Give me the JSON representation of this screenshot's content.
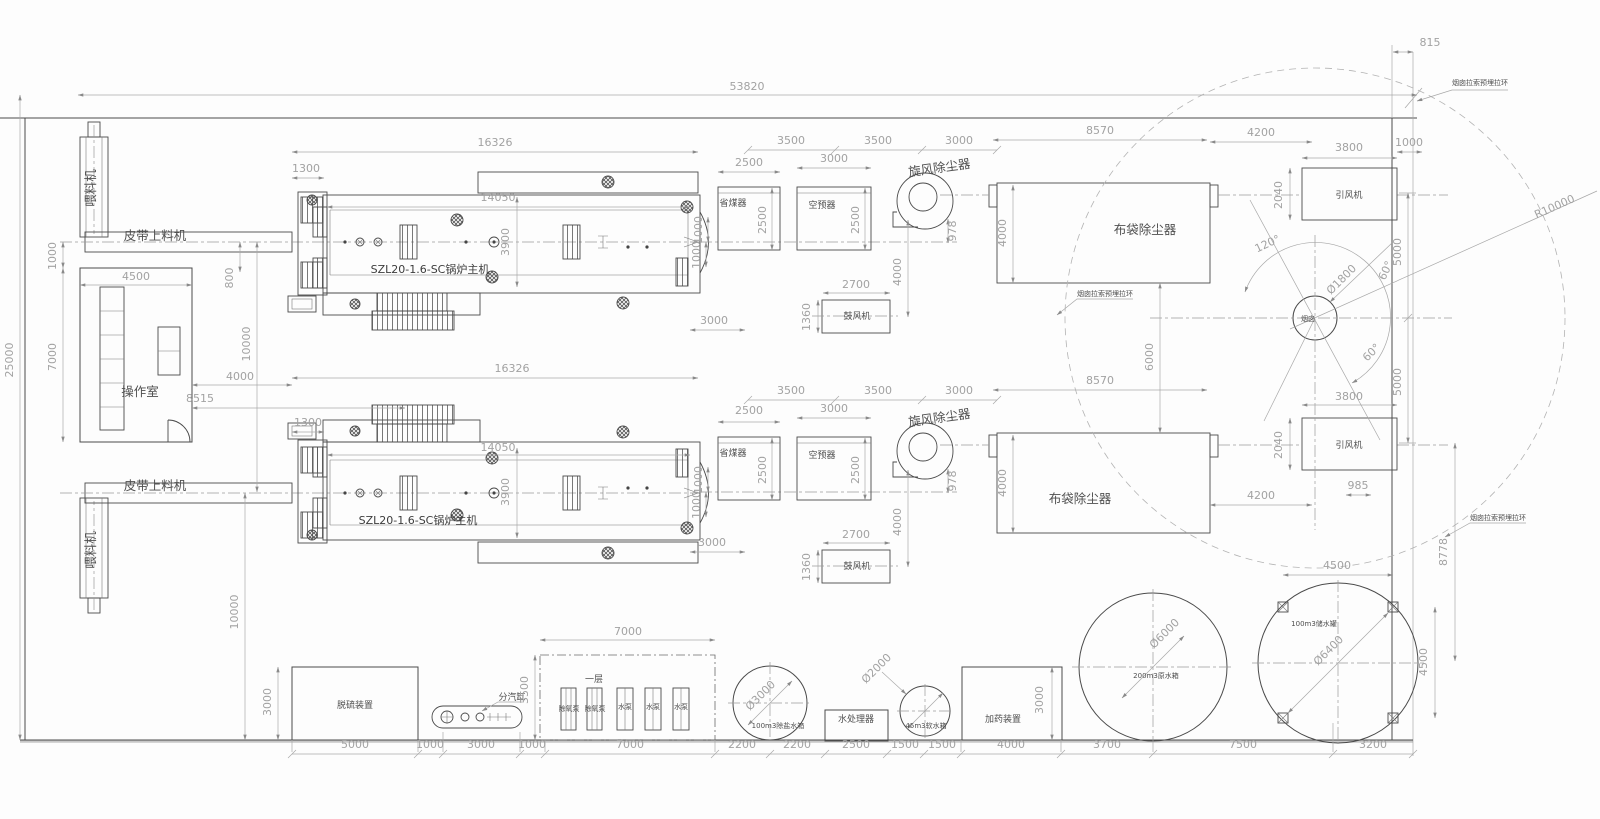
{
  "drawing": {
    "type": "boiler-plant-layout-plan",
    "boiler_model": "SZL20-1.6-SC锅炉主机",
    "site_width_label": "53820",
    "site_height_label": "25000"
  },
  "colors": {
    "line": "#4a4a4a",
    "dim_text": "#a2a2a2",
    "label_text": "#4f4f4f",
    "background": "#fdfdfd"
  },
  "texts": [
    {
      "n": "dim-site-width",
      "t": "53820",
      "x": 747,
      "y": 90
    },
    {
      "n": "dim-815",
      "t": "815",
      "x": 1430,
      "y": 46
    },
    {
      "n": "label-guy-ring-1",
      "t": "烟囱拉索预埋拉环",
      "x": 1480,
      "y": 85,
      "c": "tiny"
    },
    {
      "n": "dim-r10000",
      "t": "R10000",
      "x": 1556,
      "y": 210,
      "r": -24
    },
    {
      "n": "dim-1000-idfan1",
      "t": "1000",
      "x": 1409,
      "y": 146
    },
    {
      "n": "dim-3800-idfan1",
      "t": "3800",
      "x": 1349,
      "y": 151
    },
    {
      "n": "dim-4200-1",
      "t": "4200",
      "x": 1261,
      "y": 136
    },
    {
      "n": "dim-8570-1",
      "t": "8570",
      "x": 1100,
      "y": 134
    },
    {
      "n": "dim-3000-chain1",
      "t": "3000",
      "x": 959,
      "y": 144
    },
    {
      "n": "dim-3500-chain1b",
      "t": "3500",
      "x": 878,
      "y": 144
    },
    {
      "n": "dim-3500-chain1a",
      "t": "3500",
      "x": 791,
      "y": 144
    },
    {
      "n": "dim-2500-econ1",
      "t": "2500",
      "x": 749,
      "y": 166
    },
    {
      "n": "dim-3000-aph1",
      "t": "3000",
      "x": 834,
      "y": 162
    },
    {
      "n": "dim-16326-1",
      "t": "16326",
      "x": 495,
      "y": 146
    },
    {
      "n": "dim-1300-1",
      "t": "1300",
      "x": 306,
      "y": 172
    },
    {
      "n": "dim-14050-1",
      "t": "14050",
      "x": 498,
      "y": 201
    },
    {
      "n": "label-cyclone-1",
      "t": "旋风除尘器",
      "x": 940,
      "y": 172,
      "r": -8,
      "c": "lbl"
    },
    {
      "n": "label-economizer-1",
      "t": "省煤器",
      "x": 733,
      "y": 206,
      "c": "sm"
    },
    {
      "n": "label-air-preheater-1",
      "t": "空预器",
      "x": 822,
      "y": 208,
      "c": "sm"
    },
    {
      "n": "dim-2500v-econ1",
      "t": "2500",
      "x": 766,
      "y": 220,
      "r": -90
    },
    {
      "n": "dim-2500v-aph1",
      "t": "2500",
      "x": 859,
      "y": 220,
      "r": -90
    },
    {
      "n": "dim-1000v-econ1",
      "t": "1000",
      "x": 702,
      "y": 230,
      "r": -90
    },
    {
      "n": "dim-3900-1",
      "t": "3900",
      "x": 509,
      "y": 242,
      "r": -90
    },
    {
      "n": "dim-1000v-boiler1",
      "t": "1000",
      "x": 700,
      "y": 255,
      "r": -90
    },
    {
      "n": "label-boiler-1",
      "t": "SZL20-1.6-SC锅炉主机",
      "x": 430,
      "y": 273,
      "c": "lbl2"
    },
    {
      "n": "label-hopper-feeder-1",
      "t": "喂料机",
      "x": 95,
      "y": 188,
      "r": -90,
      "c": "lbl"
    },
    {
      "n": "label-belt-feeder-1",
      "t": "皮带上料机",
      "x": 155,
      "y": 240,
      "c": "lbl"
    },
    {
      "n": "dim-1000-room",
      "t": "1000",
      "x": 56,
      "y": 256,
      "r": -90
    },
    {
      "n": "dim-4500-room",
      "t": "4500",
      "x": 136,
      "y": 280
    },
    {
      "n": "dim-7000-room",
      "t": "7000",
      "x": 56,
      "y": 357,
      "r": -90
    },
    {
      "n": "label-control-room",
      "t": "操作室",
      "x": 140,
      "y": 396,
      "c": "lbl"
    },
    {
      "n": "dim-8515",
      "t": "8515",
      "x": 200,
      "y": 402
    },
    {
      "n": "dim-4000-room",
      "t": "4000",
      "x": 240,
      "y": 380
    },
    {
      "n": "dim-800",
      "t": "800",
      "x": 233,
      "y": 278,
      "r": -90
    },
    {
      "n": "dim-10000-upper",
      "t": "10000",
      "x": 250,
      "y": 344,
      "r": -90
    },
    {
      "n": "dim-25000",
      "t": "25000",
      "x": 13,
      "y": 360,
      "r": -90
    },
    {
      "n": "dim-978-1",
      "t": "978",
      "x": 956,
      "y": 231,
      "r": -90
    },
    {
      "n": "dim-4000-cyc1",
      "t": "4000",
      "x": 901,
      "y": 272,
      "r": -90
    },
    {
      "n": "dim-2700-1",
      "t": "2700",
      "x": 856,
      "y": 288
    },
    {
      "n": "dim-1360-1",
      "t": "1360",
      "x": 810,
      "y": 317,
      "r": -90
    },
    {
      "n": "label-blower-1",
      "t": "鼓风机",
      "x": 857,
      "y": 319,
      "c": "sm"
    },
    {
      "n": "dim-3000-gap1",
      "t": "3000",
      "x": 714,
      "y": 324
    },
    {
      "n": "label-baghouse-1",
      "t": "布袋除尘器",
      "x": 1145,
      "y": 234,
      "c": "lbl"
    },
    {
      "n": "dim-4000-bag1",
      "t": "4000",
      "x": 1006,
      "y": 233,
      "r": -90
    },
    {
      "n": "label-guy-ring-2",
      "t": "烟囱拉索预埋拉环",
      "x": 1105,
      "y": 296,
      "c": "tiny"
    },
    {
      "n": "dim-6000",
      "t": "6000",
      "x": 1153,
      "y": 357,
      "r": -90
    },
    {
      "n": "label-id-fan-1",
      "t": "引风机",
      "x": 1349,
      "y": 198,
      "c": "sm"
    },
    {
      "n": "dim-2040-1",
      "t": "2040",
      "x": 1282,
      "y": 195,
      "r": -90
    },
    {
      "n": "dim-120deg",
      "t": "120°",
      "x": 1269,
      "y": 247,
      "r": -25
    },
    {
      "n": "dim-d1800",
      "t": "Ø1800",
      "x": 1344,
      "y": 282,
      "r": -45
    },
    {
      "n": "dim-60deg-a",
      "t": "60°",
      "x": 1389,
      "y": 272,
      "r": -65
    },
    {
      "n": "dim-60deg-b",
      "t": "60°",
      "x": 1374,
      "y": 355,
      "r": -45
    },
    {
      "n": "dim-5000-a",
      "t": "5000",
      "x": 1401,
      "y": 252,
      "r": -90
    },
    {
      "n": "dim-5000-b",
      "t": "5000",
      "x": 1401,
      "y": 382,
      "r": -90
    },
    {
      "n": "label-chimney",
      "t": "烟囱",
      "x": 1308,
      "y": 321,
      "c": "tiny"
    },
    {
      "n": "dim-16326-2",
      "t": "16326",
      "x": 512,
      "y": 372
    },
    {
      "n": "dim-3500-chain2a",
      "t": "3500",
      "x": 791,
      "y": 394
    },
    {
      "n": "dim-3500-chain2b",
      "t": "3500",
      "x": 878,
      "y": 394
    },
    {
      "n": "dim-3000-chain2",
      "t": "3000",
      "x": 959,
      "y": 394
    },
    {
      "n": "dim-8570-2",
      "t": "8570",
      "x": 1100,
      "y": 384
    },
    {
      "n": "dim-2500-econ2",
      "t": "2500",
      "x": 749,
      "y": 414
    },
    {
      "n": "dim-3000-aph2",
      "t": "3000",
      "x": 834,
      "y": 412
    },
    {
      "n": "dim-1300-2",
      "t": "1300",
      "x": 308,
      "y": 426
    },
    {
      "n": "dim-14050-2",
      "t": "14050",
      "x": 498,
      "y": 451
    },
    {
      "n": "label-cyclone-2",
      "t": "旋风除尘器",
      "x": 940,
      "y": 422,
      "r": -8,
      "c": "lbl"
    },
    {
      "n": "label-economizer-2",
      "t": "省煤器",
      "x": 733,
      "y": 456,
      "c": "sm"
    },
    {
      "n": "label-air-preheater-2",
      "t": "空预器",
      "x": 822,
      "y": 458,
      "c": "sm"
    },
    {
      "n": "dim-2500v-econ2",
      "t": "2500",
      "x": 766,
      "y": 470,
      "r": -90
    },
    {
      "n": "dim-2500v-aph2",
      "t": "2500",
      "x": 859,
      "y": 470,
      "r": -90
    },
    {
      "n": "dim-1000v-econ2",
      "t": "1000",
      "x": 702,
      "y": 480,
      "r": -90
    },
    {
      "n": "dim-3900-2",
      "t": "3900",
      "x": 509,
      "y": 492,
      "r": -90
    },
    {
      "n": "dim-3800-idfan2",
      "t": "3800",
      "x": 1349,
      "y": 400
    },
    {
      "n": "label-id-fan-2",
      "t": "引风机",
      "x": 1349,
      "y": 448,
      "c": "sm"
    },
    {
      "n": "dim-2040-2",
      "t": "2040",
      "x": 1282,
      "y": 445,
      "r": -90
    },
    {
      "n": "label-baghouse-2",
      "t": "布袋除尘器",
      "x": 1080,
      "y": 503,
      "c": "lbl"
    },
    {
      "n": "dim-4000-bag2",
      "t": "4000",
      "x": 1006,
      "y": 483,
      "r": -90
    },
    {
      "n": "dim-978-2",
      "t": "978",
      "x": 956,
      "y": 481,
      "r": -90
    },
    {
      "n": "dim-4000-cyc2",
      "t": "4000",
      "x": 901,
      "y": 522,
      "r": -90
    },
    {
      "n": "label-belt-feeder-2",
      "t": "皮带上料机",
      "x": 155,
      "y": 490,
      "c": "lbl"
    },
    {
      "n": "label-hopper-feeder-2",
      "t": "喂料机",
      "x": 95,
      "y": 550,
      "r": -90,
      "c": "lbl"
    },
    {
      "n": "label-boiler-2",
      "t": "SZL20-1.6-SC锅炉主机",
      "x": 418,
      "y": 524,
      "c": "lbl2"
    },
    {
      "n": "dim-1000v-boiler2",
      "t": "1000",
      "x": 700,
      "y": 505,
      "r": -90
    },
    {
      "n": "dim-3000-gap2",
      "t": "3000",
      "x": 712,
      "y": 546
    },
    {
      "n": "dim-2700-2",
      "t": "2700",
      "x": 856,
      "y": 538
    },
    {
      "n": "dim-1360-2",
      "t": "1360",
      "x": 810,
      "y": 567,
      "r": -90
    },
    {
      "n": "label-blower-2",
      "t": "鼓风机",
      "x": 857,
      "y": 569,
      "c": "sm"
    },
    {
      "n": "dim-4200-2",
      "t": "4200",
      "x": 1261,
      "y": 499
    },
    {
      "n": "dim-985",
      "t": "985",
      "x": 1358,
      "y": 489
    },
    {
      "n": "dim-10000-lower",
      "t": "10000",
      "x": 238,
      "y": 612,
      "r": -90
    },
    {
      "n": "dim-8778",
      "t": "8778",
      "x": 1447,
      "y": 552,
      "r": -90
    },
    {
      "n": "dim-4500-tank-v",
      "t": "4500",
      "x": 1427,
      "y": 662,
      "r": -90
    },
    {
      "n": "label-guy-ring-3",
      "t": "烟囱拉索预埋拉环",
      "x": 1498,
      "y": 520,
      "c": "tiny"
    },
    {
      "n": "dim-4500-tank-h",
      "t": "4500",
      "x": 1337,
      "y": 569
    },
    {
      "n": "label-desulfurizer",
      "t": "脱硫装置",
      "x": 355,
      "y": 708,
      "c": "sm"
    },
    {
      "n": "dim-3000-desulf",
      "t": "3000",
      "x": 271,
      "y": 702,
      "r": -90
    },
    {
      "n": "label-steam-header",
      "t": "分汽缸",
      "x": 512,
      "y": 700,
      "c": "sm"
    },
    {
      "n": "dim-3500-pumphouse",
      "t": "3500",
      "x": 528,
      "y": 690,
      "r": -90
    },
    {
      "n": "dim-7000-pumphouse",
      "t": "7000",
      "x": 628,
      "y": 635
    },
    {
      "n": "label-first-floor",
      "t": "一层",
      "x": 594,
      "y": 682,
      "c": "sm"
    },
    {
      "n": "label-deaerator-pump-1",
      "t": "除氧泵",
      "x": 569,
      "y": 711,
      "c": "tiny"
    },
    {
      "n": "label-deaerator-pump-2",
      "t": "除氧泵",
      "x": 595,
      "y": 711,
      "c": "tiny"
    },
    {
      "n": "label-water-pump-1",
      "t": "水泵",
      "x": 625,
      "y": 709,
      "c": "tiny"
    },
    {
      "n": "label-water-pump-2",
      "t": "水泵",
      "x": 653,
      "y": 709,
      "c": "tiny"
    },
    {
      "n": "label-water-pump-3",
      "t": "水泵",
      "x": 681,
      "y": 709,
      "c": "tiny"
    },
    {
      "n": "dim-d3000",
      "t": "Ø3000",
      "x": 763,
      "y": 698,
      "r": -45
    },
    {
      "n": "label-demi-water-tank",
      "t": "100m3除盐水箱",
      "x": 778,
      "y": 728,
      "c": "tiny"
    },
    {
      "n": "label-water-treater",
      "t": "水处理器",
      "x": 856,
      "y": 722,
      "c": "sm"
    },
    {
      "n": "dim-d2000",
      "t": "Ø2000",
      "x": 879,
      "y": 671,
      "r": -45
    },
    {
      "n": "label-soft-water-tank",
      "t": "45m3软水箱",
      "x": 926,
      "y": 728,
      "c": "tiny"
    },
    {
      "n": "label-dosing-unit",
      "t": "加药装置",
      "x": 1003,
      "y": 722,
      "c": "sm"
    },
    {
      "n": "dim-3000-dosing",
      "t": "3000",
      "x": 1043,
      "y": 700,
      "r": -90
    },
    {
      "n": "dim-d6000",
      "t": "Ø6000",
      "x": 1167,
      "y": 636,
      "r": -45
    },
    {
      "n": "label-raw-water-tank",
      "t": "200m3原水箱",
      "x": 1156,
      "y": 678,
      "c": "tiny"
    },
    {
      "n": "dim-d6400",
      "t": "Ø6400",
      "x": 1331,
      "y": 653,
      "r": -45
    },
    {
      "n": "label-storage-tank",
      "t": "100m3储水罐",
      "x": 1314,
      "y": 626,
      "c": "tiny"
    },
    {
      "n": "dim-5000-bottom",
      "t": "5000",
      "x": 355,
      "y": 748
    },
    {
      "n": "dim-1000-bottom-a",
      "t": "1000",
      "x": 430,
      "y": 748
    },
    {
      "n": "dim-3000-bottom",
      "t": "3000",
      "x": 481,
      "y": 748
    },
    {
      "n": "dim-1000-bottom-b",
      "t": "1000",
      "x": 532,
      "y": 748
    },
    {
      "n": "dim-7000-bottom",
      "t": "7000",
      "x": 630,
      "y": 748
    },
    {
      "n": "dim-2200-a",
      "t": "2200",
      "x": 742,
      "y": 748
    },
    {
      "n": "dim-2200-b",
      "t": "2200",
      "x": 797,
      "y": 748
    },
    {
      "n": "dim-2500-bottom",
      "t": "2500",
      "x": 856,
      "y": 748
    },
    {
      "n": "dim-1500-a",
      "t": "1500",
      "x": 905,
      "y": 748
    },
    {
      "n": "dim-1500-b",
      "t": "1500",
      "x": 942,
      "y": 748
    },
    {
      "n": "dim-4000-bottom",
      "t": "4000",
      "x": 1011,
      "y": 748
    },
    {
      "n": "dim-3700-bottom",
      "t": "3700",
      "x": 1107,
      "y": 748
    },
    {
      "n": "dim-7500-bottom",
      "t": "7500",
      "x": 1243,
      "y": 748
    },
    {
      "n": "dim-3200-bottom",
      "t": "3200",
      "x": 1373,
      "y": 748
    }
  ]
}
